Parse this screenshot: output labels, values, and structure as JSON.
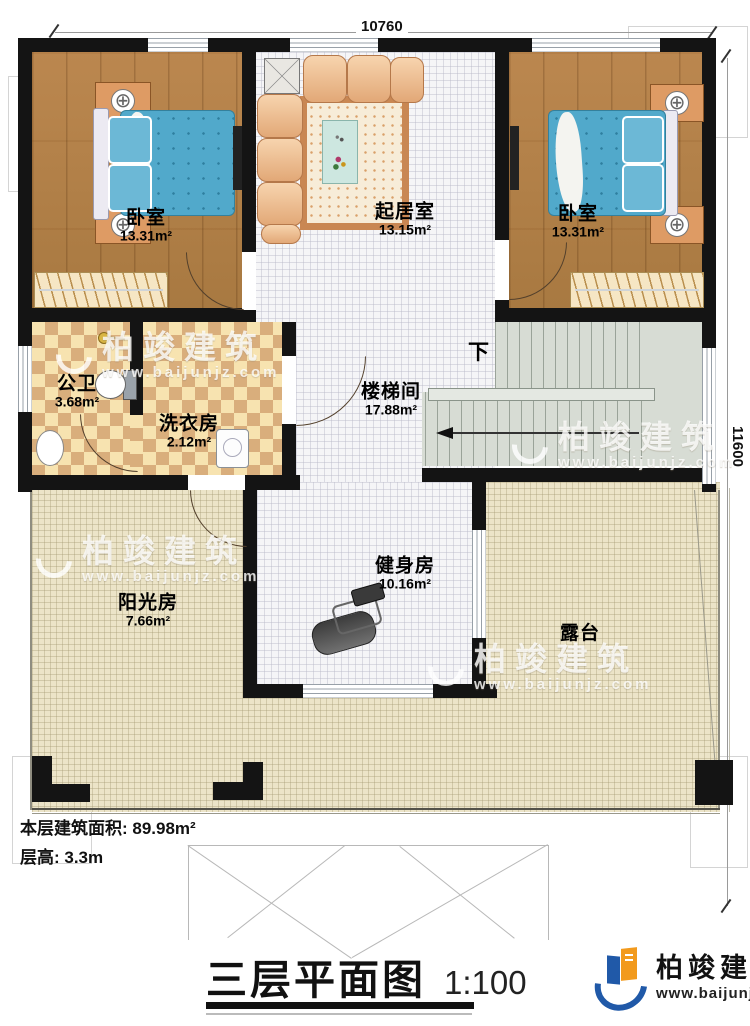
{
  "dims": {
    "top": "10760",
    "right": "11600"
  },
  "stair": {
    "down": "下"
  },
  "rooms": {
    "bedroom_left": {
      "name": "卧室",
      "area": "13.31m²"
    },
    "living": {
      "name": "起居室",
      "area": "13.15m²"
    },
    "bedroom_right": {
      "name": "卧室",
      "area": "13.31m²"
    },
    "bathroom": {
      "name": "公卫",
      "area": "3.68m²"
    },
    "laundry": {
      "name": "洗衣房",
      "area": "2.12m²"
    },
    "stairwell": {
      "name": "楼梯间",
      "area": "17.88m²"
    },
    "gym": {
      "name": "健身房",
      "area": "10.16m²"
    },
    "sunroom": {
      "name": "阳光房",
      "area": "7.66m²"
    },
    "terrace": {
      "name": "露台"
    }
  },
  "info": {
    "area": "本层建筑面积: 89.98m²",
    "height": "层高: 3.3m"
  },
  "title": {
    "text": "三层平面图",
    "scale": "1:100"
  },
  "brand": {
    "name": "柏竣建筑",
    "url": "www.baijunjz.com"
  },
  "watermark": {
    "name": "柏竣建筑",
    "url": "www.baijunjz.com"
  },
  "colors": {
    "wall": "#141414",
    "wood": "#b28049",
    "tile": "#f5f5f7",
    "checker": "#d9ae7c",
    "terrace": "#ece4c8",
    "stairs": "#d7dcd4",
    "bed": "#51a9cb",
    "brand_blue": "#2059a8",
    "brand_orange": "#f29a1d"
  }
}
